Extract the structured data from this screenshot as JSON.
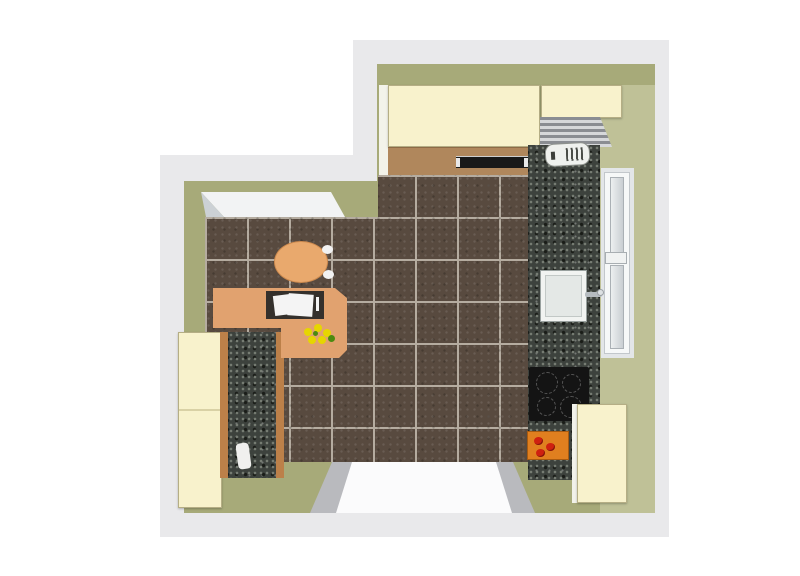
{
  "scene": {
    "type": "kitchen-floorplan-render",
    "view": "top-down",
    "room_shape": "L-shaped (notched rectangle)"
  },
  "palette": {
    "page_bg": "#ffffff",
    "outline": "#e9e9eb",
    "wall_olive": "#a7aa79",
    "wall_khaki_light": "#bfc197",
    "floor_brown": "#584a3f",
    "floor_grout": "#b5aca0",
    "granite_base": "#3d423d",
    "granite_light": "#777d74",
    "granite_dark": "#1a1d18",
    "cabinet_cream": "#f8f2cc",
    "cabinet_edge": "#b5ae85",
    "counter_tan": "#b0875c",
    "wood_desk": "#e1a26f",
    "wood_edge": "#bc8049",
    "chair_orange": "#e9a96d",
    "white": "#f2f3f4",
    "window_pane": "#ccd1d5",
    "appliance_black": "#141414",
    "board_orange": "#e07f1f",
    "tomato_red": "#cf2010",
    "flower_yellow": "#e6d600",
    "flower_green": "#4c8a10",
    "stripe_dark": "#8a8d92",
    "stripe_light": "#d6d8da",
    "door_white": "#fbfbfc",
    "door_gray": "#b9babe",
    "tray_dark": "#34302c"
  },
  "objects": {
    "room": {
      "label": "Kitchen floor plan (top-down render)"
    },
    "wallband": {
      "label": "Room walls (olive band)"
    },
    "floor": {
      "label": "Dark brown tiled floor"
    },
    "doorway": {
      "label": "Doorway opening (bottom wall)"
    },
    "sill_top_left": {
      "label": "Window sill (top-left wall)"
    },
    "window_right": {
      "label": "Window (right wall)"
    },
    "wall_cabinet_large": {
      "label": "Wall cabinet run (top, large)"
    },
    "wall_cabinet_small": {
      "label": "Wall cabinet (top right)"
    },
    "slatted_unit": {
      "label": "Slatted unit / shutter cabinet (top-right corner)"
    },
    "counter_top_run": {
      "label": "Worktop along top wall"
    },
    "hood_strip": {
      "label": "Dark appliance strip on top worktop"
    },
    "granite_right": {
      "label": "Granite worktop (right wall run)"
    },
    "boiler": {
      "label": "White appliance with grille (boiler)"
    },
    "sink": {
      "label": "Kitchen sink"
    },
    "faucet": {
      "label": "Faucet"
    },
    "cooktop": {
      "label": "Black cooktop with four burners"
    },
    "cutting_board": {
      "label": "Cutting board with tomatoes"
    },
    "tall_cabinet_bottom_right": {
      "label": "Tall cream cabinet (bottom-right)"
    },
    "tall_cabinet_left": {
      "label": "Tall cream cabinet (left wall)"
    },
    "granite_left": {
      "label": "Granite counter strip (left, wood-edged)"
    },
    "jug": {
      "label": "White jug on left counter"
    },
    "desk": {
      "label": "L-shaped beech desk/table"
    },
    "tray": {
      "label": "Dark tray with white papers"
    },
    "flowers": {
      "label": "Yellow flowers on desk"
    },
    "chair": {
      "label": "Round chair"
    }
  }
}
